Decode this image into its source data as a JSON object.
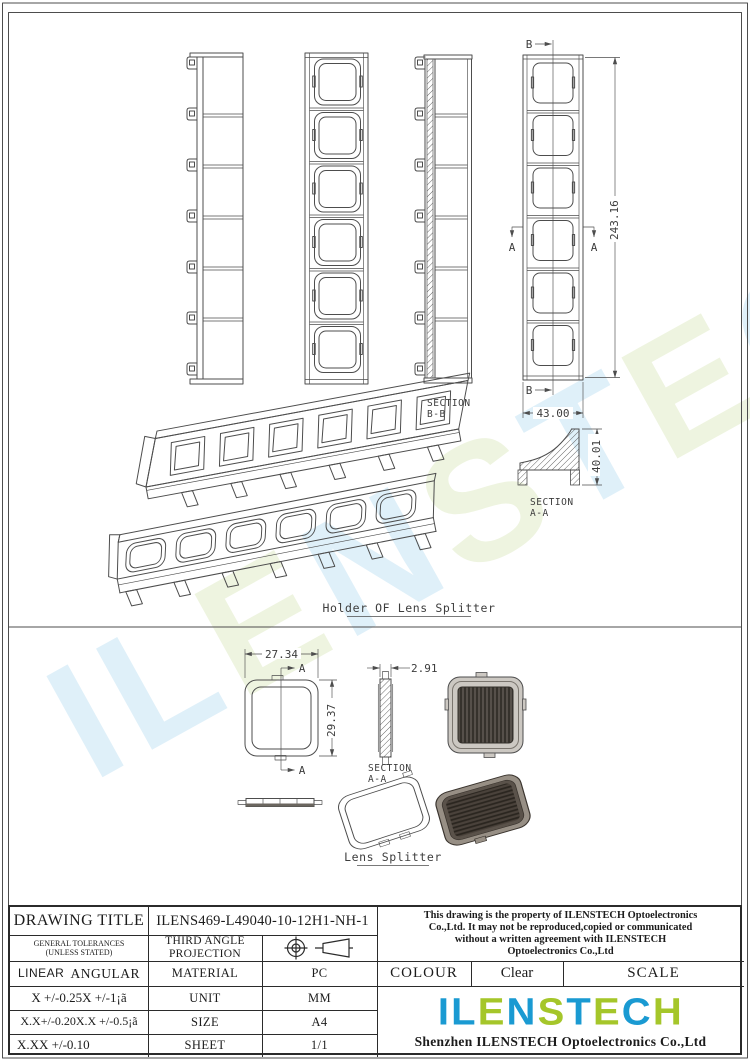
{
  "brand": {
    "letters": [
      {
        "ch": "I",
        "tone": "blue"
      },
      {
        "ch": "L",
        "tone": "blue"
      },
      {
        "ch": "E",
        "tone": "green"
      },
      {
        "ch": "N",
        "tone": "blue"
      },
      {
        "ch": "S",
        "tone": "green"
      },
      {
        "ch": "T",
        "tone": "blue"
      },
      {
        "ch": "E",
        "tone": "green"
      },
      {
        "ch": "C",
        "tone": "blue"
      },
      {
        "ch": "H",
        "tone": "green"
      }
    ],
    "logo_blue": "#1a9ad2",
    "logo_green": "#a5c62a",
    "watermark_blue": "#d5ebf7",
    "watermark_green": "#e9f1d6"
  },
  "holder": {
    "title": "Holder OF Lens Splitter",
    "dim_height": "243.16",
    "dim_width": "43.00",
    "dim_profile_height": "40.01",
    "section_bb_line1": "SECTION",
    "section_bb_line2": "B-B",
    "section_aa_line1": "SECTION",
    "section_aa_line2": "A-A",
    "marker_a": "A",
    "marker_b": "B"
  },
  "lens": {
    "title": "Lens Splitter",
    "dim_width": "27.34",
    "dim_height": "29.37",
    "dim_thickness": "2.91",
    "section_aa_line1": "SECTION",
    "section_aa_line2": "A-A",
    "marker_a": "A"
  },
  "title_block": {
    "drawing_title_label": "DRAWING TITLE",
    "drawing_number": "ILENS469-L49040-10-12H1-NH-1",
    "tolerances_heading_line1": "GENERAL TOLERANCES",
    "tolerances_heading_line2": "(UNLESS STATED)",
    "projection_line1": "THIRD ANGLE",
    "projection_line2": "PROJECTION",
    "linear_label": "LINEAR",
    "angular_label": "ANGULAR",
    "material_label": "MATERIAL",
    "material_value": "PC",
    "unit_label": "UNIT",
    "unit_value": "MM",
    "size_label": "SIZE",
    "size_value": "A4",
    "sheet_label": "SHEET",
    "sheet_value": "1/1",
    "tol_linear_1": "X  +/-0.25",
    "tol_angular_1": "X  +/-1¡ã",
    "tol_linear_2": "X.X+/-0.20",
    "tol_angular_2": "X.X +/-0.5¡ã",
    "tol_linear_3": "X.XX +/-0.10",
    "property_line1": "This drawing is the property of ILENSTECH Optoelectronics",
    "property_line2": "Co.,Ltd. It may not be reproduced,copied or communicated",
    "property_line3": "without a written agreement with ILENSTECH",
    "property_line4": "Optoelectronics Co.,Ltd",
    "colour_label": "COLOUR",
    "colour_value": "Clear",
    "scale_label": "SCALE",
    "company_name": "Shenzhen ILENSTECH Optoelectronics Co.,Ltd"
  }
}
